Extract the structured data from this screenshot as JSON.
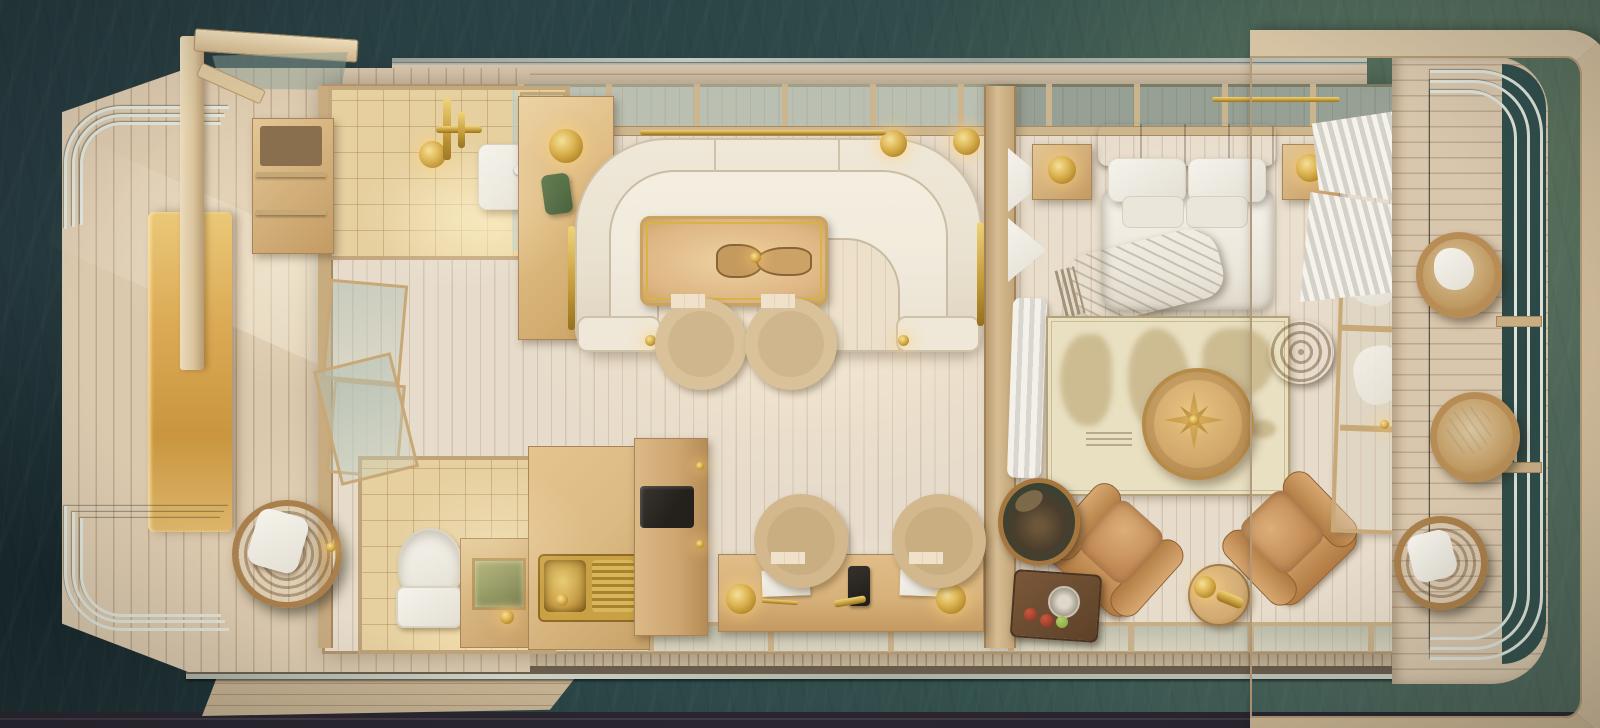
{
  "scene": {
    "description": "Top-down 3D rendered floor plan of a luxury houseboat floating on dark teal water",
    "view": "aerial top-down",
    "vessel": "houseboat suite",
    "areas": {
      "left_deck": {
        "name": "bow deck",
        "items": [
          "wood plank decking",
          "golden lit bench",
          "curved metal railing top",
          "curved metal railing bottom",
          "hanging rattan egg chair with white cushion",
          "pergola corner frame with glass panel"
        ]
      },
      "shower_room": {
        "name": "shower room",
        "items": [
          "beige tiled floor",
          "brass rain shower head",
          "brass mixer pipes",
          "white shower tray",
          "glass partition",
          "open storage shelf",
          "green towel bag on bar cabinet",
          "brass dome lamp"
        ]
      },
      "living_room": {
        "name": "salon",
        "items": [
          "U-shaped cream sofa",
          "brass arm rails",
          "wood dining table with brass trim",
          "carved wood centerpiece",
          "two beige barrel chairs",
          "brass wall sconces",
          "brass wall rail",
          "glass skylight band"
        ]
      },
      "office_kitchen": {
        "name": "galley and desk",
        "items": [
          "brass sink with drainboard",
          "L-shaped counter",
          "tall cabinet with black screen",
          "writing desk",
          "two beige desk chairs",
          "two brass desk lamps",
          "white note pads",
          "black phone",
          "brass pen"
        ]
      },
      "wc": {
        "name": "water closet",
        "items": [
          "white toilet",
          "wood vanity",
          "mirror",
          "brass faucet",
          "glass door to deck"
        ]
      },
      "bedroom": {
        "name": "stateroom",
        "items": [
          "double bed",
          "grey tufted headboard",
          "four white pillows",
          "white duvet",
          "taupe throw blanket",
          "two nightstands",
          "two brass lamps",
          "world map rug",
          "round carved compass table",
          "two tan leather armchairs",
          "round side table with brass telescope",
          "potted plant",
          "fruit tray with glass",
          "rattan ball decor",
          "white curtains",
          "glass wardrobe wall"
        ]
      },
      "right_deck": {
        "name": "stern deck",
        "items": [
          "wood rim frame",
          "triple curved metal railing",
          "three hanging rattan chairs with white cushions",
          "water gap",
          "railing connectors"
        ]
      },
      "perimeter": {
        "items": [
          "top gunwale walkway with rail",
          "bottom gunwale walkway with rail",
          "swim platform bottom left"
        ]
      }
    },
    "counts": {
      "hanging_chairs_right_deck": 3,
      "leather_armchairs": 2,
      "dining_chairs": 2,
      "desk_chairs": 2,
      "nightstands": 2,
      "brass_lamps": 6
    }
  },
  "palette": {
    "water_dark": "#25383d",
    "water_green": "#51675a",
    "deck": "#dbc9ae",
    "floor": "#e7dccb",
    "wall": "#c9ab80",
    "wood_mid": "#d3b184",
    "gold": "#b78a2c",
    "gold_hi": "#f5e09a",
    "cream_sofa": "#eae2d1",
    "leather": "#c28a55",
    "tile": "#e6d0a0",
    "white_linen": "#f2efe7",
    "rail": "#dfe3d9",
    "map_parchment": "#e9e0c2",
    "headboard_grey": "#8d8579",
    "throw_taupe": "#ac9d85",
    "plant_green": "#4a3d2c",
    "bag_green": "#5f7a4e"
  }
}
